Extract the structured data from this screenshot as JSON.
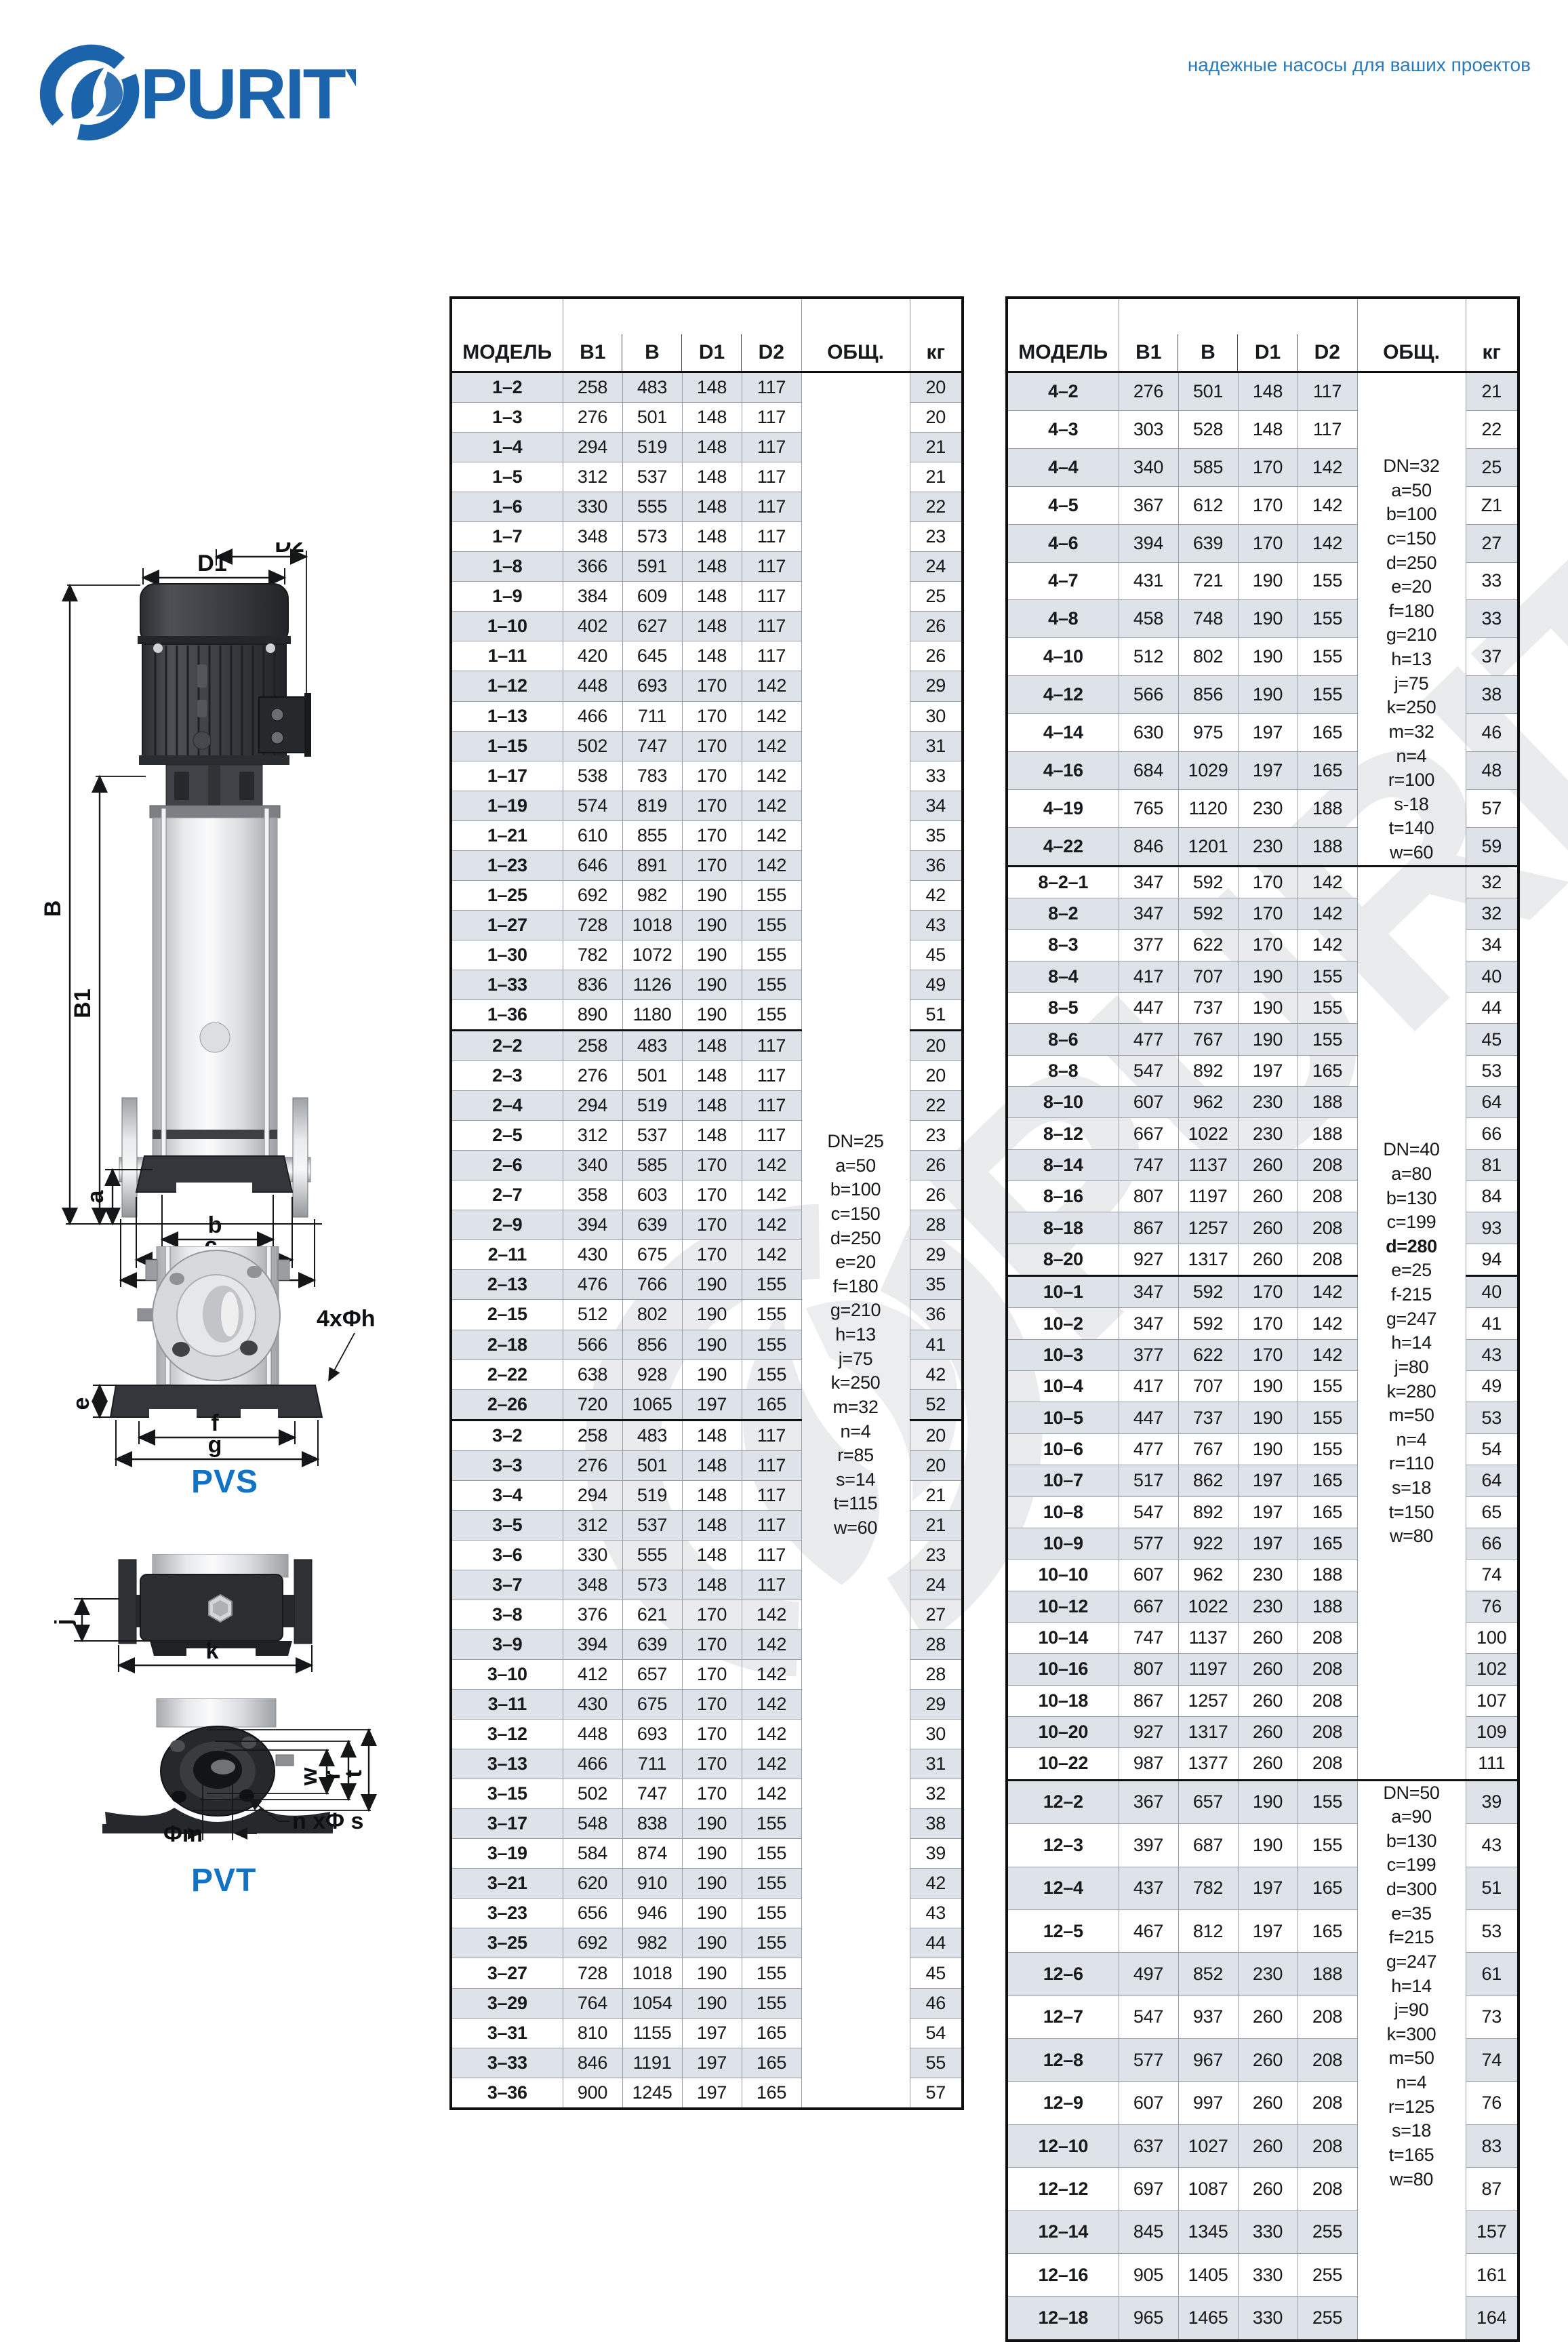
{
  "brand": {
    "name": "PURITY",
    "tagline": "надежные насосы для ваших проектов"
  },
  "diagram_labels": {
    "pvs": "PVS",
    "pvt": "PVT",
    "d1": "D1",
    "d2": "D2",
    "b_total": "B",
    "b1": "B1",
    "a": "a",
    "b": "b",
    "c": "c",
    "d": "d",
    "e": "e",
    "f": "f",
    "g": "g",
    "flange_holes": "4xΦh",
    "j": "j",
    "k": "k",
    "w": "w",
    "r": "r",
    "t": "t",
    "phi_m": "Φm",
    "n_phi_s": "n xΦ s"
  },
  "tables": [
    {
      "headers": {
        "model": "МОДЕЛЬ",
        "b1": "B1",
        "b": "B",
        "d1": "D1",
        "d2": "D2",
        "notes": "ОБЩ.",
        "kg": "кг"
      },
      "sections": [
        {
          "rows": [
            [
              "1–2",
              258,
              483,
              148,
              117,
              20
            ],
            [
              "1–3",
              276,
              501,
              148,
              117,
              20
            ],
            [
              "1–4",
              294,
              519,
              148,
              117,
              21
            ],
            [
              "1–5",
              312,
              537,
              148,
              117,
              21
            ],
            [
              "1–6",
              330,
              555,
              148,
              117,
              22
            ],
            [
              "1–7",
              348,
              573,
              148,
              117,
              23
            ],
            [
              "1–8",
              366,
              591,
              148,
              117,
              24
            ],
            [
              "1–9",
              384,
              609,
              148,
              117,
              25
            ],
            [
              "1–10",
              402,
              627,
              148,
              117,
              26
            ],
            [
              "1–11",
              420,
              645,
              148,
              117,
              26
            ],
            [
              "1–12",
              448,
              693,
              170,
              142,
              29
            ],
            [
              "1–13",
              466,
              711,
              170,
              142,
              30
            ],
            [
              "1–15",
              502,
              747,
              170,
              142,
              31
            ],
            [
              "1–17",
              538,
              783,
              170,
              142,
              33
            ],
            [
              "1–19",
              574,
              819,
              170,
              142,
              34
            ],
            [
              "1–21",
              610,
              855,
              170,
              142,
              35
            ],
            [
              "1–23",
              646,
              891,
              170,
              142,
              36
            ],
            [
              "1–25",
              692,
              982,
              190,
              155,
              42
            ],
            [
              "1–27",
              728,
              1018,
              190,
              155,
              43
            ],
            [
              "1–30",
              782,
              1072,
              190,
              155,
              45
            ],
            [
              "1–33",
              836,
              1126,
              190,
              155,
              49
            ],
            [
              "1–36",
              890,
              1180,
              190,
              155,
              51
            ]
          ]
        },
        {
          "rows": [
            [
              "2–2",
              258,
              483,
              148,
              117,
              20
            ],
            [
              "2–3",
              276,
              501,
              148,
              117,
              20
            ],
            [
              "2–4",
              294,
              519,
              148,
              117,
              22
            ],
            [
              "2–5",
              312,
              537,
              148,
              117,
              23
            ],
            [
              "2–6",
              340,
              585,
              170,
              142,
              26
            ],
            [
              "2–7",
              358,
              603,
              170,
              142,
              26
            ],
            [
              "2–9",
              394,
              639,
              170,
              142,
              28
            ],
            [
              "2–11",
              430,
              675,
              170,
              142,
              29
            ],
            [
              "2–13",
              476,
              766,
              190,
              155,
              35
            ],
            [
              "2–15",
              512,
              802,
              190,
              155,
              36
            ],
            [
              "2–18",
              566,
              856,
              190,
              155,
              41
            ],
            [
              "2–22",
              638,
              928,
              190,
              155,
              42
            ],
            [
              "2–26",
              720,
              1065,
              197,
              165,
              52
            ]
          ]
        },
        {
          "rows": [
            [
              "3–2",
              258,
              483,
              148,
              117,
              20
            ],
            [
              "3–3",
              276,
              501,
              148,
              117,
              20
            ],
            [
              "3–4",
              294,
              519,
              148,
              117,
              21
            ],
            [
              "3–5",
              312,
              537,
              148,
              117,
              21
            ],
            [
              "3–6",
              330,
              555,
              148,
              117,
              23
            ],
            [
              "3–7",
              348,
              573,
              148,
              117,
              24
            ],
            [
              "3–8",
              376,
              621,
              170,
              142,
              27
            ],
            [
              "3–9",
              394,
              639,
              170,
              142,
              28
            ],
            [
              "3–10",
              412,
              657,
              170,
              142,
              28
            ],
            [
              "3–11",
              430,
              675,
              170,
              142,
              29
            ],
            [
              "3–12",
              448,
              693,
              170,
              142,
              30
            ],
            [
              "3–13",
              466,
              711,
              170,
              142,
              31
            ],
            [
              "3–15",
              502,
              747,
              170,
              142,
              32
            ],
            [
              "3–17",
              548,
              838,
              190,
              155,
              38
            ],
            [
              "3–19",
              584,
              874,
              190,
              155,
              39
            ],
            [
              "3–21",
              620,
              910,
              190,
              155,
              42
            ],
            [
              "3–23",
              656,
              946,
              190,
              155,
              43
            ],
            [
              "3–25",
              692,
              982,
              190,
              155,
              44
            ],
            [
              "3–27",
              728,
              1018,
              190,
              155,
              45
            ],
            [
              "3–29",
              764,
              1054,
              190,
              155,
              46
            ],
            [
              "3–31",
              810,
              1155,
              197,
              165,
              54
            ],
            [
              "3–33",
              846,
              1191,
              197,
              165,
              55
            ],
            [
              "3–36",
              900,
              1245,
              197,
              165,
              57
            ]
          ]
        }
      ],
      "note_blocks": [
        {
          "section": 0,
          "span": 58,
          "lines": [
            "DN=25",
            "a=50",
            "b=100",
            "c=150",
            "d=250",
            "e=20",
            "f=180",
            "g=210",
            "h=13",
            "j=75",
            "k=250",
            "m=32",
            "n=4",
            "r=85",
            "s=14",
            "t=115",
            "w=60"
          ]
        }
      ]
    },
    {
      "headers": {
        "model": "МОДЕЛЬ",
        "b1": "B1",
        "b": "B",
        "d1": "D1",
        "d2": "D2",
        "notes": "ОБЩ.",
        "kg": "кг"
      },
      "sections": [
        {
          "rows": [
            [
              "4–2",
              276,
              501,
              148,
              117,
              21
            ],
            [
              "4–3",
              303,
              528,
              148,
              117,
              22
            ],
            [
              "4–4",
              340,
              585,
              170,
              142,
              25
            ],
            [
              "4–5",
              367,
              612,
              170,
              142,
              "Z1"
            ],
            [
              "4–6",
              394,
              639,
              170,
              142,
              27
            ],
            [
              "4–7",
              431,
              721,
              190,
              155,
              33
            ],
            [
              "4–8",
              458,
              748,
              190,
              155,
              33
            ],
            [
              "4–10",
              512,
              802,
              190,
              155,
              37
            ],
            [
              "4–12",
              566,
              856,
              190,
              155,
              38
            ],
            [
              "4–14",
              630,
              975,
              197,
              165,
              46
            ],
            [
              "4–16",
              684,
              1029,
              197,
              165,
              48
            ],
            [
              "4–19",
              765,
              1120,
              230,
              188,
              57
            ],
            [
              "4–22",
              846,
              1201,
              230,
              188,
              59
            ]
          ]
        },
        {
          "rows": [
            [
              "8–2–1",
              347,
              592,
              170,
              142,
              32
            ],
            [
              "8–2",
              347,
              592,
              170,
              142,
              32
            ],
            [
              "8–3",
              377,
              622,
              170,
              142,
              34
            ],
            [
              "8–4",
              417,
              707,
              190,
              155,
              40
            ],
            [
              "8–5",
              447,
              737,
              190,
              155,
              44
            ],
            [
              "8–6",
              477,
              767,
              190,
              155,
              45
            ],
            [
              "8–8",
              547,
              892,
              197,
              165,
              53
            ],
            [
              "8–10",
              607,
              962,
              230,
              188,
              64
            ],
            [
              "8–12",
              667,
              1022,
              230,
              188,
              66
            ],
            [
              "8–14",
              747,
              1137,
              260,
              208,
              81
            ],
            [
              "8–16",
              807,
              1197,
              260,
              208,
              84
            ],
            [
              "8–18",
              867,
              1257,
              260,
              208,
              93
            ],
            [
              "8–20",
              927,
              1317,
              260,
              208,
              94
            ]
          ]
        },
        {
          "rows": [
            [
              "10–1",
              347,
              592,
              170,
              142,
              40
            ],
            [
              "10–2",
              347,
              592,
              170,
              142,
              41
            ],
            [
              "10–3",
              377,
              622,
              170,
              142,
              43
            ],
            [
              "10–4",
              417,
              707,
              190,
              155,
              49
            ],
            [
              "10–5",
              447,
              737,
              190,
              155,
              53
            ],
            [
              "10–6",
              477,
              767,
              190,
              155,
              54
            ],
            [
              "10–7",
              517,
              862,
              197,
              165,
              64
            ],
            [
              "10–8",
              547,
              892,
              197,
              165,
              65
            ],
            [
              "10–9",
              577,
              922,
              197,
              165,
              66
            ],
            [
              "10–10",
              607,
              962,
              230,
              188,
              74
            ],
            [
              "10–12",
              667,
              1022,
              230,
              188,
              76
            ],
            [
              "10–14",
              747,
              1137,
              260,
              208,
              100
            ],
            [
              "10–16",
              807,
              1197,
              260,
              208,
              102
            ],
            [
              "10–18",
              867,
              1257,
              260,
              208,
              107
            ],
            [
              "10–20",
              927,
              1317,
              260,
              208,
              109
            ],
            [
              "10–22",
              987,
              1377,
              260,
              208,
              111
            ]
          ]
        },
        {
          "rows": [
            [
              "12–2",
              367,
              657,
              190,
              155,
              39
            ],
            [
              "12–3",
              397,
              687,
              190,
              155,
              43
            ],
            [
              "12–4",
              437,
              782,
              197,
              165,
              51
            ],
            [
              "12–5",
              467,
              812,
              197,
              165,
              53
            ],
            [
              "12–6",
              497,
              852,
              230,
              188,
              61
            ],
            [
              "12–7",
              547,
              937,
              260,
              208,
              73
            ],
            [
              "12–8",
              577,
              967,
              260,
              208,
              74
            ],
            [
              "12–9",
              607,
              997,
              260,
              208,
              76
            ],
            [
              "12–10",
              637,
              1027,
              260,
              208,
              83
            ],
            [
              "12–12",
              697,
              1087,
              260,
              208,
              87
            ],
            [
              "12–14",
              845,
              1345,
              330,
              255,
              157
            ],
            [
              "12–16",
              905,
              1405,
              330,
              255,
              161
            ],
            [
              "12–18",
              965,
              1465,
              330,
              255,
              164
            ]
          ]
        }
      ],
      "note_blocks": [
        {
          "section": 0,
          "span": 13,
          "lines": [
            "DN=32",
            "a=50",
            "b=100",
            "c=150",
            "d=250",
            "e=20",
            "f=180",
            "g=210",
            "h=13",
            "j=75",
            "k=250",
            "m=32",
            "n=4",
            "r=100",
            "s-18",
            "t=140",
            "w=60"
          ]
        },
        {
          "section": 1,
          "span": 29,
          "bold_line": "d=280",
          "lines": [
            "DN=40",
            "a=80",
            "b=130",
            "c=199",
            "d=280",
            "e=25",
            "f-215",
            "g=247",
            "h=14",
            "j=80",
            "k=280",
            "m=50",
            "n=4",
            "r=110",
            "s=18",
            "t=150",
            "w=80"
          ]
        },
        {
          "section": 3,
          "span": 13,
          "lines": [
            "DN=50",
            "a=90",
            "b=130",
            "c=199",
            "d=300",
            "e=35",
            "f=215",
            "g=247",
            "h=14",
            "j=90",
            "k=300",
            "m=50",
            "n=4",
            "r=125",
            "s=18",
            "t=165",
            "w=80"
          ]
        }
      ]
    }
  ]
}
